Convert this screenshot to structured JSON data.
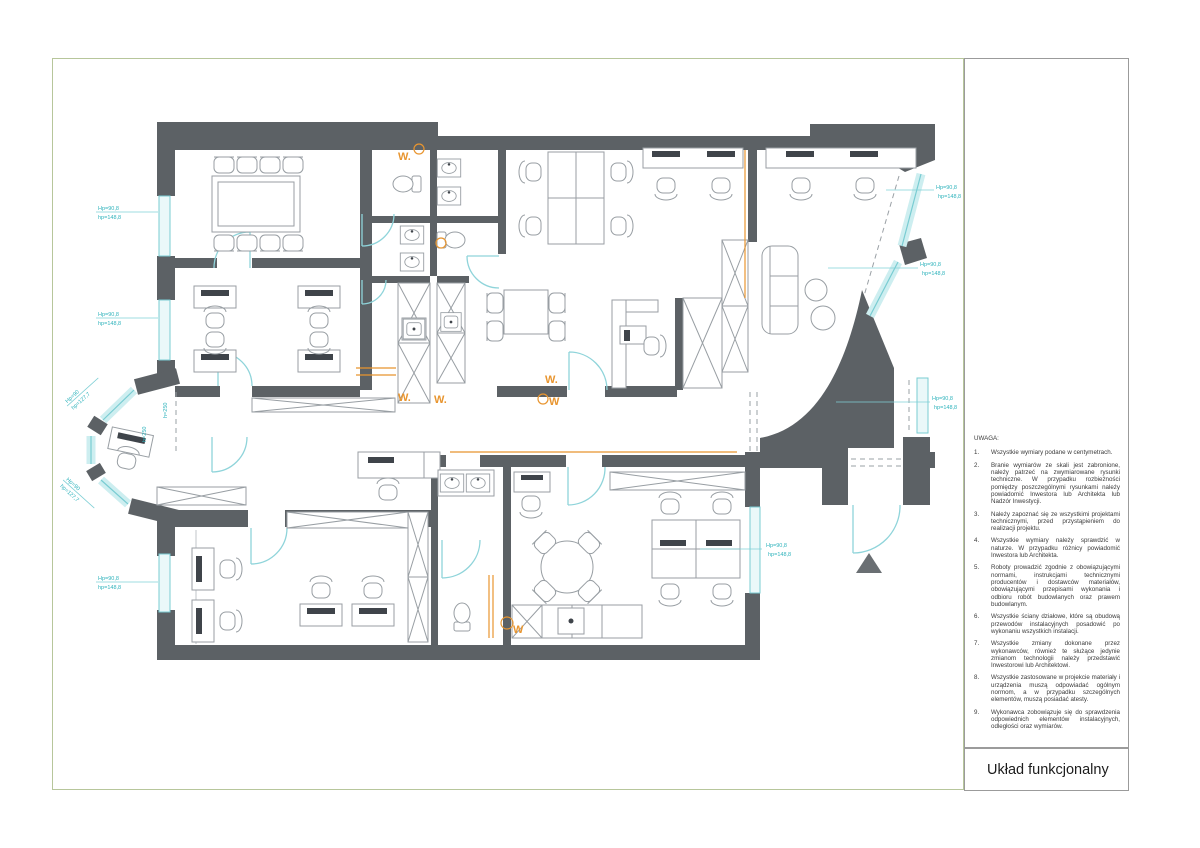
{
  "title_block": {
    "title": "Układ funkcjonalny"
  },
  "notes": {
    "heading": "UWAGA:",
    "items": [
      {
        "num": "1.",
        "text": "Wszystkie wymiary podane w centymetrach."
      },
      {
        "num": "2.",
        "text": "Branie wymiarów ze skali jest zabronione, należy patrzeć na zwymiarowane rysunki techniczne. W przypadku rozbieżności pomiędzy poszczególnymi rysunkami należy powiadomić Inwestora lub Architekta lub Nadzór Inwestycji."
      },
      {
        "num": "3.",
        "text": "Należy zapoznać się ze wszystkimi projektami technicznymi, przed przystąpieniem do realizacji projektu."
      },
      {
        "num": "4.",
        "text": "Wszystkie wymiary należy sprawdzić w naturze. W przypadku różnicy powiadomić Inwestora lub Architekta."
      },
      {
        "num": "5.",
        "text": "Roboty prowadzić zgodnie z obowiązującymi normami, instrukcjami technicznymi producentów i dostawców materiałów, obowiązującymi przepisami wykonania i odbioru robót budowlanych oraz prawem budowlanym."
      },
      {
        "num": "6.",
        "text": "Wszystkie ściany działowe, które są obudową przewodów instalacyjnych posadowić po wykonaniu wszystkich instalacji."
      },
      {
        "num": "7.",
        "text": "Wszystkie zmiany dokonane przez wykonawców, również te służące jedynie zmianom technologii należy przedstawić Inwestorowi lub Architektowi."
      },
      {
        "num": "8.",
        "text": "Wszystkie zastosowane w projekcie materiały i urządzenia muszą odpowiadać ogólnym normom, a w przypadku szczególnych elementów, muszą posiadać atesty."
      },
      {
        "num": "9.",
        "text": "Wykonawca zobowiązuje się do sprawdzenia odpowiednich elementów instalacyjnych, odległości oraz wymiarów."
      }
    ]
  },
  "plan": {
    "lab_std": {
      "line1": "Hp=90,8",
      "line2": "hp=148,8"
    },
    "lab_bay": {
      "line1": "Hp=90",
      "line2": "hp=127,7"
    },
    "lab_h250": "h=250",
    "w_dot": "W.",
    "w_plain": "W"
  },
  "colors": {
    "wall": "#5c6165",
    "window_cyan": "#79ccd2",
    "dimension_cyan": "#2fb3bc",
    "marker_orange": "#e8952f",
    "frame_olive": "#b7c69b"
  }
}
